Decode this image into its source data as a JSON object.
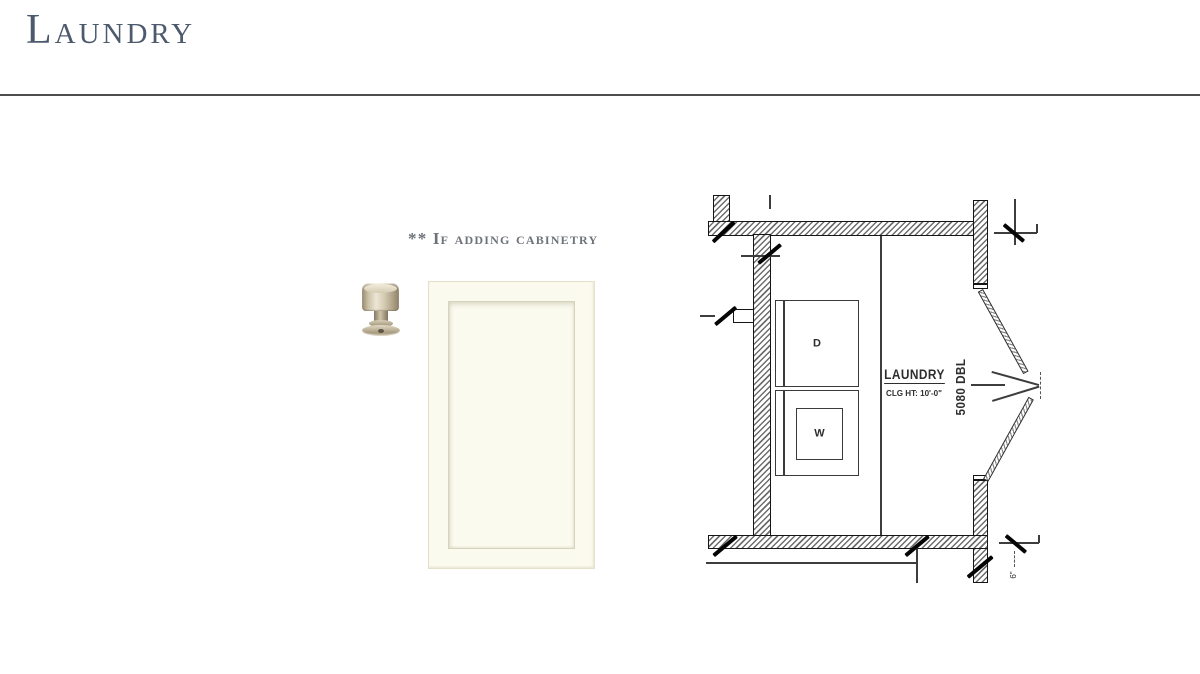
{
  "page": {
    "title": "Laundry",
    "note": "** If adding cabinetry"
  },
  "colors": {
    "title_text": "#4d5a6d",
    "note_text": "#6e737a",
    "rule": "#4d4d4d",
    "door_face": "#fbfaee",
    "plan_line": "#151515",
    "knob_metal": "#cfc5ac"
  },
  "floor_plan": {
    "room_label": "LAUNDRY",
    "ceiling_note": "CLG HT: 10'-0\"",
    "door_size": "5080 DBL",
    "dryer_label": "D",
    "washer_label": "W",
    "dim_note": "6\""
  }
}
